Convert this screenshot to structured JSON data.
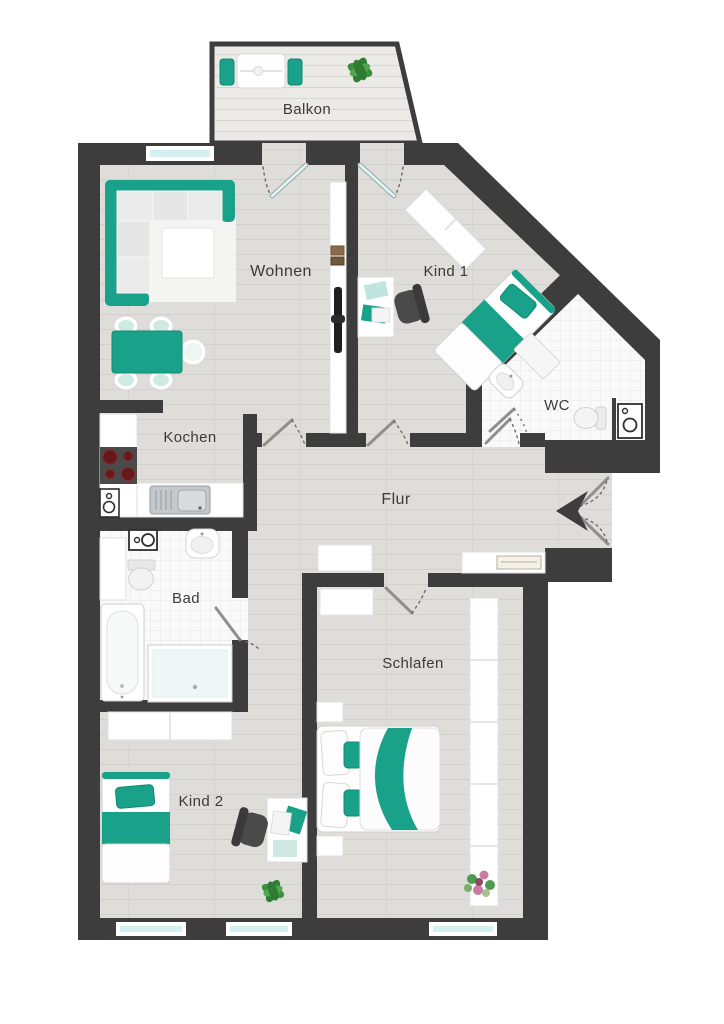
{
  "plan": {
    "title": "Grundriss Wohnung",
    "rooms": {
      "balkon": {
        "label": "Balkon"
      },
      "wohnen": {
        "label": "Wohnen"
      },
      "kind1": {
        "label": "Kind 1"
      },
      "wc": {
        "label": "WC"
      },
      "kochen": {
        "label": "Kochen"
      },
      "flur": {
        "label": "Flur"
      },
      "bad": {
        "label": "Bad"
      },
      "schlafen": {
        "label": "Schlafen"
      },
      "kind2": {
        "label": "Kind 2"
      }
    },
    "colors": {
      "wall": "#3d3d3d",
      "wood_floor": "#dfddd9",
      "tile_floor": "#fafafa",
      "accent_teal": "#19a189",
      "window_glass": "#d4f0f1",
      "furniture_white": "#ffffff",
      "chair_dark": "#4a4a4a",
      "plant_green": "#2e7d32",
      "flower_pink": "#c97ba2"
    }
  }
}
